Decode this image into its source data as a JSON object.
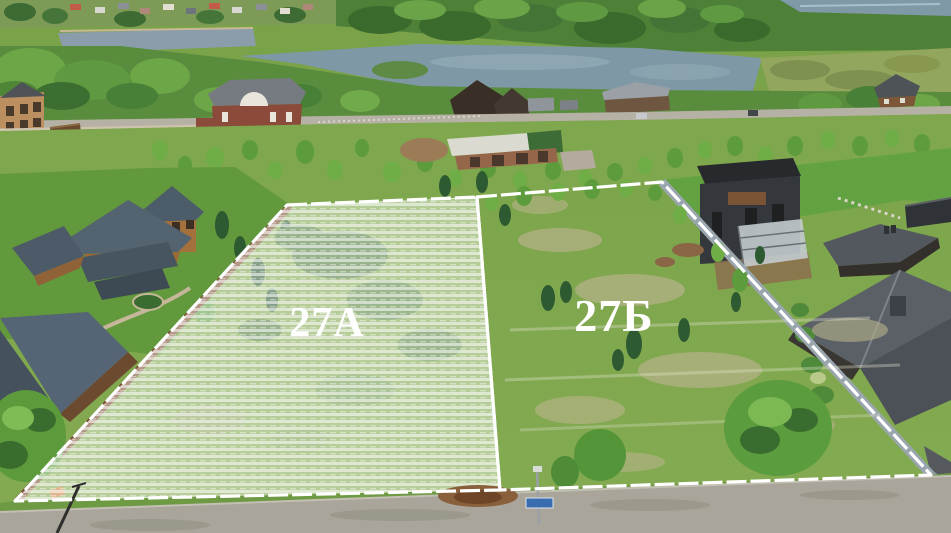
{
  "scene": {
    "type": "aerial-drone-photo",
    "description": "Aerial view of a cottage settlement by a river with two adjacent land plots outlined in white",
    "width_px": 951,
    "height_px": 533
  },
  "plots": {
    "a": {
      "label": "27А",
      "highlighted": true
    },
    "b": {
      "label": "27Б",
      "highlighted": false
    }
  },
  "colors": {
    "boundary": "#ffffff",
    "label": "#ffffff",
    "grass": "#7ca449",
    "water": "#8099a6",
    "road": "#a9a59a",
    "fence_gray": "#9aa6ae",
    "fence_brown": "#7a4a2c"
  }
}
